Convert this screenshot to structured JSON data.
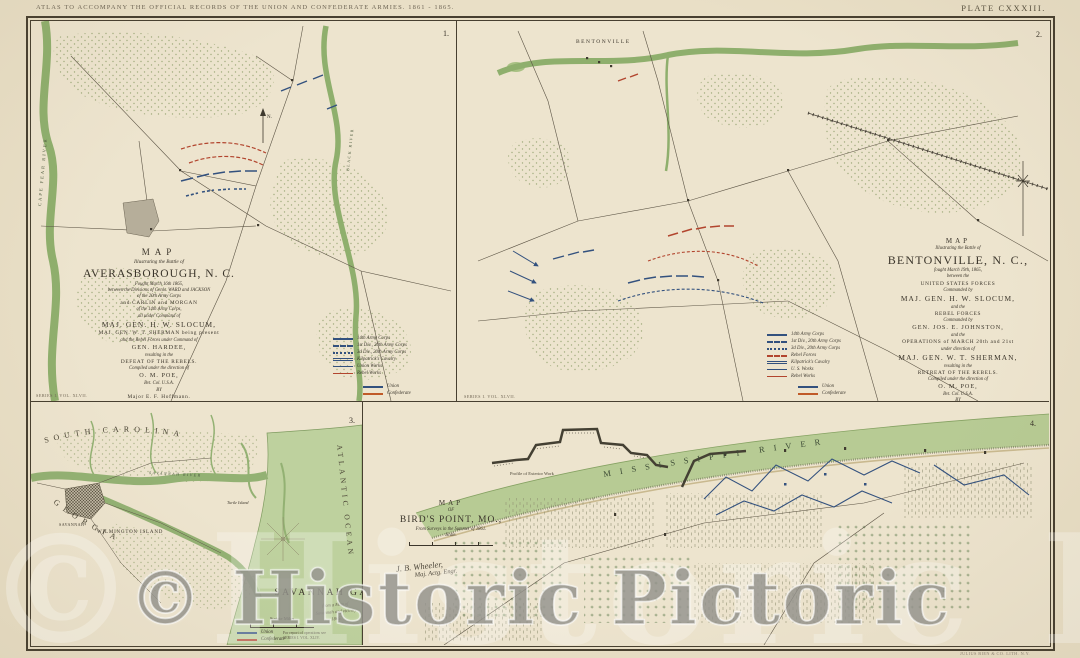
{
  "colors": {
    "paper": "#e9dfc6",
    "panel_paper": "#ede4ce",
    "frame": "#473f30",
    "ink": "#3b352b",
    "water_green": "#b7cb94",
    "water_edge": "#86a263",
    "union_blue": "#33517e",
    "rebel_red": "#b2452e",
    "confederate_orange": "#c05a28"
  },
  "header": {
    "atlas_title": "ATLAS TO ACCOMPANY THE OFFICIAL RECORDS OF THE UNION AND CONFEDERATE ARMIES. 1861 - 1865.",
    "plate_label": "PLATE CXXXIII."
  },
  "footer": {
    "lithographer": "JULIUS BIEN & CO. LITH. N.Y."
  },
  "series_notes": {
    "left": "SERIES I. VOL. XLVII.",
    "right": "SERIES I. VOL. XLVII."
  },
  "watermark": {
    "text": "© Historic Pictoric",
    "ghost_text": "© Historic Pictoric"
  },
  "averasborough": {
    "number": "1.",
    "north_label": "N.",
    "river_left_label": "CAPE FEAR RIVER",
    "river_right_label": "BLACK RIVER",
    "title": {
      "l1": "MAP",
      "l2": "Illustrating the Battle of",
      "l3": "AVERASBOROUGH, N. C.",
      "l4": "Fought March 16th 1865,",
      "l5": "between the Divisions of Genls. WARD and JACKSON",
      "l6": "of the 20th Army Corps",
      "l7": "and CARLIN and MORGAN",
      "l8": "of the 14th Army Corps,",
      "l9": "all under Command of",
      "l10": "MAJ. GEN. H. W. SLOCUM,",
      "l11": "MAJ. GEN. W. T. SHERMAN being present",
      "l12": "and the Rebel Forces under Command of",
      "l13": "GEN. HARDEE,",
      "l14": "resulting in the",
      "l15": "DEFEAT OF THE REBELS.",
      "l16": "Compiled under the direction of",
      "l17": "O. M. POE,",
      "l18": "Bvt. Col. U.S.A.",
      "l19": "BY",
      "l20": "Major E. F. Hoffmann.",
      "l21": "Scale:"
    },
    "legend": [
      {
        "label": "14th Army Corps",
        "color": "#33517e",
        "dash": "solid"
      },
      {
        "label": "1st Div., 20th Army Corps",
        "color": "#33517e",
        "dash": "dashed"
      },
      {
        "label": "3d Div., 20th Army Corps",
        "color": "#33517e",
        "dash": "dotted"
      },
      {
        "label": "Kilpatrick's Cavalry",
        "color": "#33517e",
        "dash": "double"
      },
      {
        "label": "Union Works",
        "color": "#33517e",
        "dash": "thin"
      },
      {
        "label": "Rebel Works",
        "color": "#b2452e",
        "dash": "thin"
      }
    ],
    "sub_legend": [
      {
        "label": "Union",
        "color": "#33517e",
        "dash": "solid"
      },
      {
        "label": "Confederate",
        "color": "#c05a28",
        "dash": "solid"
      }
    ]
  },
  "bentonville": {
    "number": "2.",
    "town_label": "BENTONVILLE",
    "title": {
      "l1": "MAP",
      "l2": "Illustrating the Battle of",
      "l3": "BENTONVILLE, N. C.,",
      "l4": "fought March 19th, 1865,",
      "l5": "between the",
      "l6": "UNITED STATES FORCES",
      "l7": "Commanded by",
      "l8": "MAJ. GEN. H. W. SLOCUM,",
      "l9": "and the",
      "l10": "REBEL FORCES",
      "l11": "Commanded by",
      "l12": "GEN. JOS. E. JOHNSTON,",
      "l13": "and the",
      "l14": "OPERATIONS of MARCH 20th and 21st",
      "l15": "under direction of",
      "l16": "MAJ. GEN. W. T. SHERMAN,",
      "l17": "resulting in the",
      "l18": "RETREAT OF THE REBELS.",
      "l19": "Compiled under the direction of",
      "l20": "O. M. POE,",
      "l21": "Bvt. Col. U.S.A.",
      "l22": "BY",
      "l23": "Major E. F. Hoffmann.",
      "l24": "Scale:"
    },
    "legend": [
      {
        "label": "14th Army Corps",
        "color": "#33517e",
        "dash": "solid"
      },
      {
        "label": "1st Div., 20th Army Corps",
        "color": "#33517e",
        "dash": "dashed"
      },
      {
        "label": "3d Div., 20th Army Corps",
        "color": "#33517e",
        "dash": "dotted"
      },
      {
        "label": "Rebel Forces",
        "color": "#b2452e",
        "dash": "dashed"
      },
      {
        "label": "Kilpatrick's Cavalry",
        "color": "#33517e",
        "dash": "double"
      },
      {
        "label": "U. S. Works",
        "color": "#33517e",
        "dash": "thin"
      },
      {
        "label": "Rebel Works",
        "color": "#b2452e",
        "dash": "thin"
      }
    ],
    "sub_legend": [
      {
        "label": "Union",
        "color": "#33517e",
        "dash": "solid"
      },
      {
        "label": "Confederate",
        "color": "#c05a28",
        "dash": "solid"
      }
    ]
  },
  "savannah": {
    "number": "3.",
    "title": "SAVANNAH GA.",
    "subtitle_script": [
      "from a Map of",
      "Savannah and vicinity",
      "1865."
    ],
    "scale_label": "Statute Miles",
    "labels": {
      "south_carolina": "SOUTH CAROLINA",
      "georgia": "GEORGIA",
      "atlantic_ocean": "ATLANTIC OCEAN",
      "wilmington_island": "WILMINGTON ISLAND",
      "turtle_island": "Turtle Island",
      "savannah_river": "SAVANNAH RIVER",
      "city": "SAVANNAH"
    },
    "legend": [
      {
        "label": "Union",
        "color": "#33517e",
        "dash": "solid"
      },
      {
        "label": "Confederate",
        "color": "#b2452e",
        "dash": "solid"
      }
    ],
    "footnote": [
      "For report of operations see",
      "SERIES I. VOL. XLIV."
    ]
  },
  "birdspoint": {
    "number": "4.",
    "river_label": "MISSISSIPPI RIVER",
    "profile_label": "Profile of Exterior Work",
    "title": {
      "l1": "MAP",
      "l2": "OF",
      "l3": "BIRD'S POINT, MO.,",
      "l4": "From Surveys in the Summer of 1861.",
      "l5": "Scale."
    },
    "signature": [
      "J. B. Wheeler,",
      "Maj. Actg. Engr."
    ]
  }
}
